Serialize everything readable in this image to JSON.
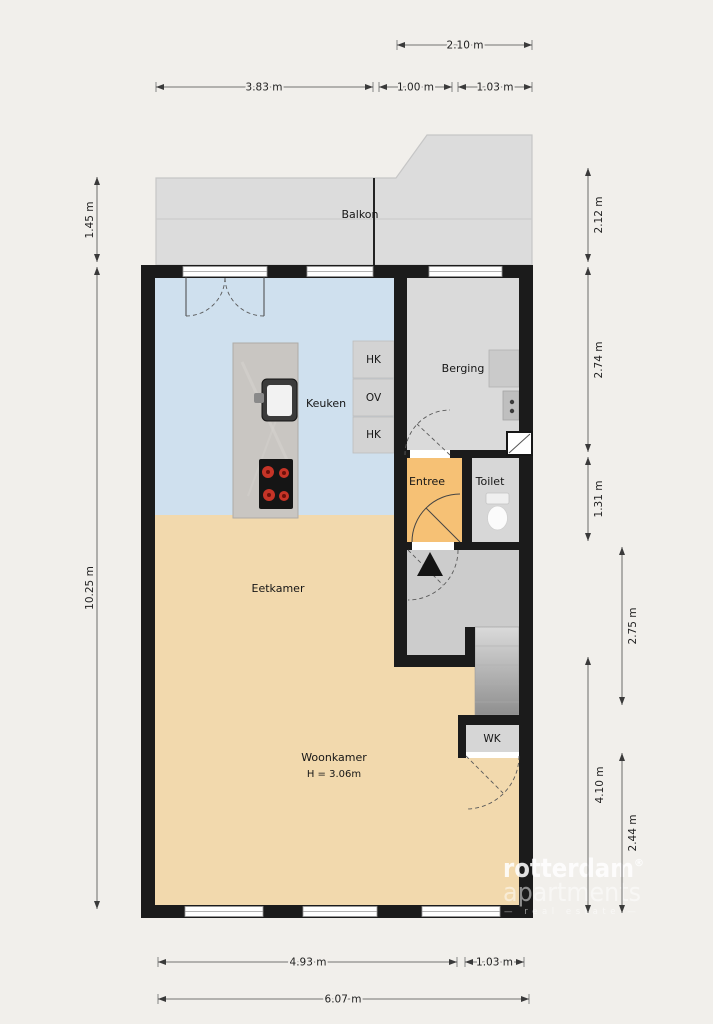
{
  "branding": {
    "name": "rotterdam",
    "registered": "®",
    "name2": "apartments",
    "tagline": "— real estate —"
  },
  "rooms": {
    "balkon": "Balkon",
    "keuken": "Keuken",
    "berging": "Berging",
    "entree": "Entree",
    "toilet": "Toilet",
    "eetkamer": "Eetkamer",
    "woonkamer": "Woonkamer",
    "woonkamer_ceiling": "H = 3.06m",
    "wk": "WK",
    "closet_top": "HK",
    "closet_mid": "OV",
    "closet_bottom": "HK"
  },
  "dimensions": {
    "top_width_right": "2.10 m",
    "top_width_left": "3.83 m",
    "top_seg_1": "1.00 m",
    "top_seg_2": "1.03 m",
    "left_balcony_depth": "1.45 m",
    "left_total_height": "10.25 m",
    "right_balcony_height": "2.12 m",
    "right_berging_height": "2.74 m",
    "right_entree_height": "1.31 m",
    "right_hall_height": "2.75 m",
    "right_lower_height": "4.10 m",
    "right_bottom_height": "2.44 m",
    "bottom_left_width": "4.93 m",
    "bottom_right_width": "1.03 m",
    "bottom_total_width": "6.07 m"
  },
  "colors": {
    "background": "#f1efeb",
    "wall": "#1b1b1b",
    "kitchen_floor": "#cfe0ee",
    "living_floor": "#f2d9ad",
    "entree_floor": "#f6c175",
    "balcony_floor": "#dcdcdc",
    "berging_floor": "#dadada",
    "hall_floor": "#cccccc",
    "toilet_floor": "#d7d7d7",
    "burner_accent": "#c63427"
  }
}
